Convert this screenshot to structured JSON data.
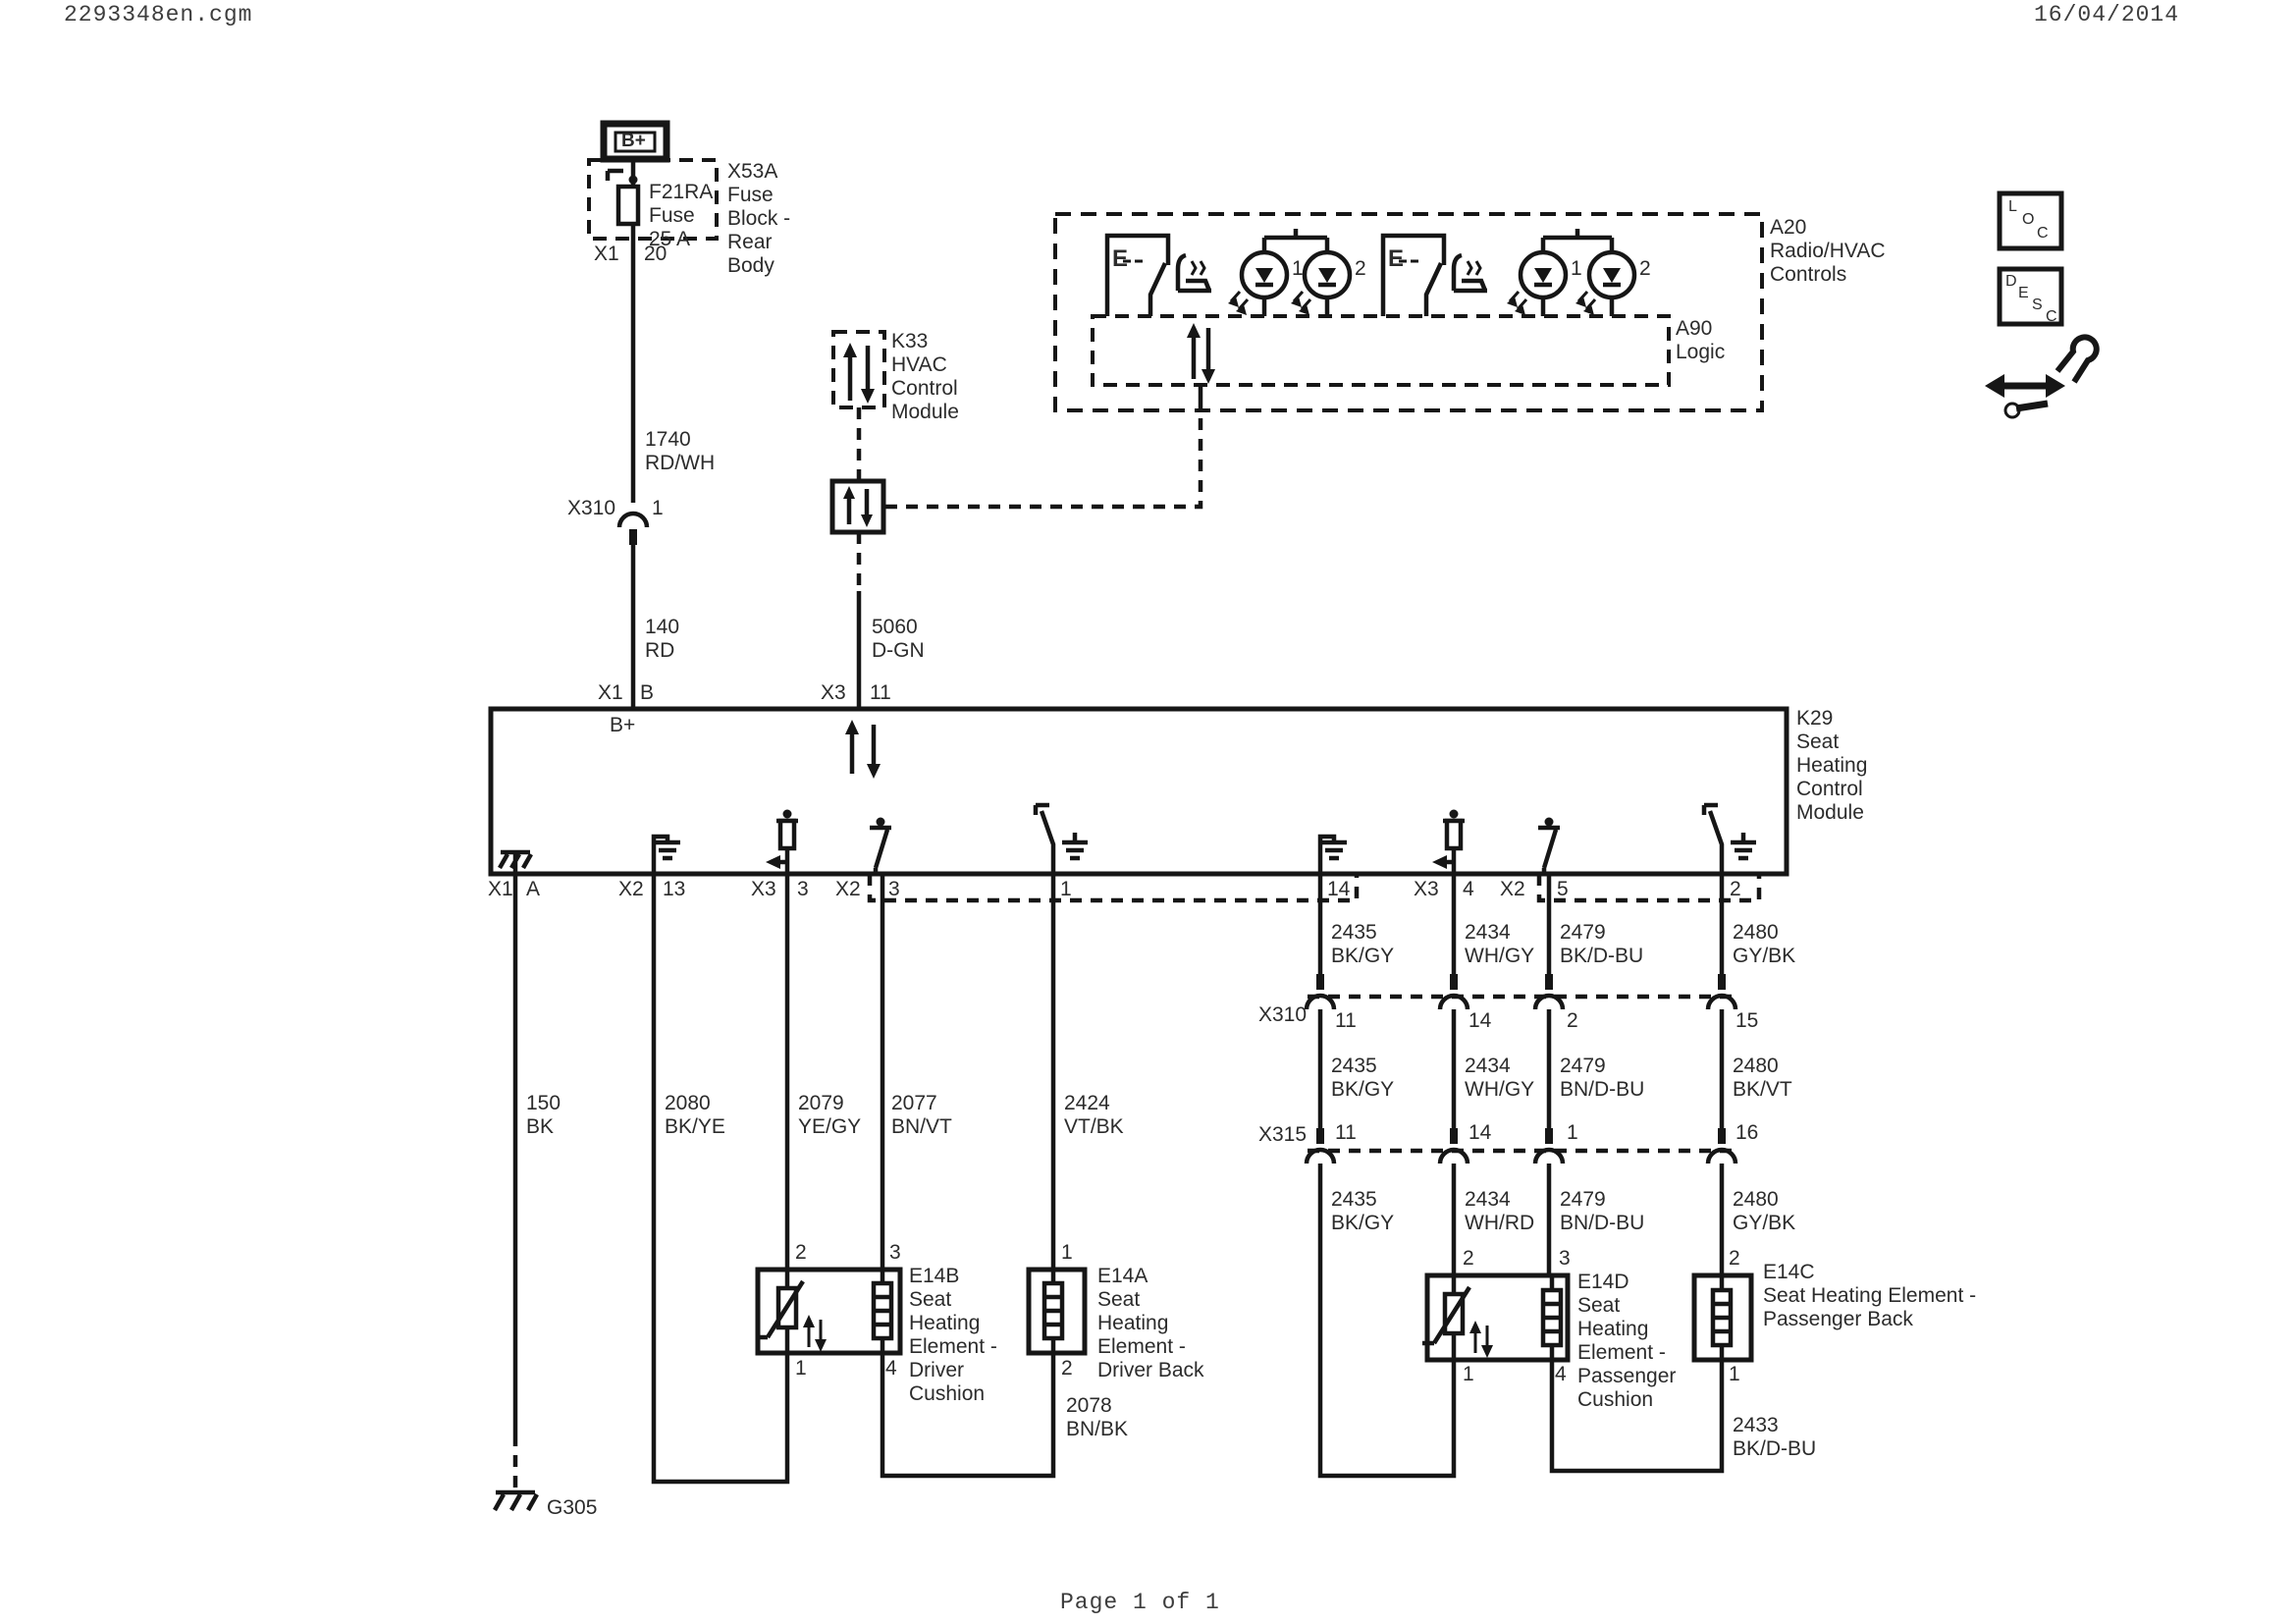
{
  "header": {
    "filename": "2293348en.cgm",
    "date": "16/04/2014"
  },
  "footer": {
    "page": "Page 1 of 1"
  },
  "battery": {
    "terminal": "B+"
  },
  "fuse_block": {
    "label": "X53A\nFuse\nBlock -\nRear\nBody",
    "fuse": "F21RA\nFuse\n25 A",
    "pin_connector": "X1",
    "pin_number": "20"
  },
  "k33": {
    "label": "K33\nHVAC\nControl\nModule"
  },
  "a20": {
    "label": "A20\nRadio/HVAC\nControls",
    "a90": "A90\nLogic",
    "switch1_letter": "E",
    "switch2_letter": "E",
    "led_labels": [
      "1",
      "2"
    ]
  },
  "sidebar": {
    "loc": [
      "L",
      "O",
      "C"
    ],
    "desc": [
      "D",
      "E",
      "S",
      "C"
    ]
  },
  "k29": {
    "label": "K29\nSeat\nHeating\nControl\nModule",
    "internal_bplus": "B+",
    "pin_x1b": {
      "conn": "X1",
      "num": "B"
    },
    "pin_x311": {
      "conn": "X3",
      "num": "11"
    },
    "pin_x1a": {
      "conn": "X1",
      "num": "A"
    },
    "pin_x213": {
      "conn": "X2",
      "num": "13"
    },
    "pin_x33": {
      "conn": "X3",
      "num": "3"
    },
    "pin_x23": {
      "conn": "X2",
      "num": "3"
    },
    "pin_1": {
      "num": "1"
    },
    "pin_14": {
      "num": "14"
    },
    "pin_x34": {
      "conn": "X3",
      "num": "4"
    },
    "pin_x25": {
      "conn": "X2",
      "num": "5"
    },
    "pin_2": {
      "num": "2"
    }
  },
  "wires": {
    "c1740": "1740\nRD/WH",
    "c140": "140\nRD",
    "c5060": "5060\nD-GN",
    "c150": "150\nBK",
    "c2080": "2080\nBK/YE",
    "c2079": "2079\nYE/GY",
    "c2077": "2077\nBN/VT",
    "c2424": "2424\nVT/BK",
    "c2078": "2078\nBN/BK",
    "c2433": "2433\nBK/D-BU",
    "right_a": [
      "2435\nBK/GY",
      "2434\nWH/GY",
      "2479\nBK/D-BU",
      "2480\nGY/BK"
    ],
    "right_b": [
      "2435\nBK/GY",
      "2434\nWH/GY",
      "2479\nBN/D-BU",
      "2480\nBK/VT"
    ],
    "right_c": [
      "2435\nBK/GY",
      "2434\nWH/RD",
      "2479\nBN/D-BU",
      "2480\nGY/BK"
    ]
  },
  "connectors": {
    "x310_main": {
      "name": "X310",
      "pin": "1"
    },
    "x310_row": {
      "name": "X310",
      "pins": [
        "11",
        "14",
        "2",
        "15"
      ]
    },
    "x315_row": {
      "name": "X315",
      "pins": [
        "11",
        "14",
        "1",
        "16"
      ]
    }
  },
  "elements": {
    "e14b": {
      "label": "E14B\nSeat\nHeating\nElement -\nDriver\nCushion",
      "pin_tl": "2",
      "pin_tr": "3",
      "pin_bl": "1",
      "pin_br": "4"
    },
    "e14a": {
      "label": "E14A\nSeat\nHeating\nElement -\nDriver Back",
      "pin_t": "1",
      "pin_b": "2"
    },
    "e14d": {
      "label": "E14D\nSeat\nHeating\nElement -\nPassenger\nCushion",
      "pin_tl": "2",
      "pin_tr": "3",
      "pin_bl": "1",
      "pin_br": "4"
    },
    "e14c": {
      "label": "E14C\nSeat Heating Element -\nPassenger Back",
      "pin_t": "2",
      "pin_b": "1"
    }
  },
  "grounds": {
    "g305": "G305"
  }
}
